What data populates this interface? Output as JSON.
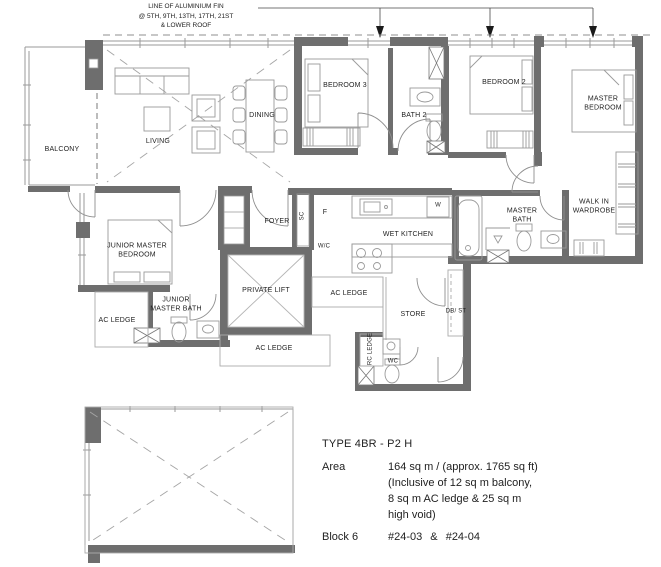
{
  "annotation": {
    "line1": "LINE OF ALUMINIUM FIN",
    "line2": "@ 5TH, 9TH, 13TH, 17TH, 21ST",
    "line3": "&  LOWER ROOF"
  },
  "rooms": {
    "balcony": "BALCONY",
    "living": "LIVING",
    "dining": "DINING",
    "bedroom3": "BEDROOM 3",
    "bath2": "BATH 2",
    "bedroom2": "BEDROOM 2",
    "master_bedroom": "MASTER BEDROOM",
    "walk_in_wardrobe": "WALK IN WARDROBE",
    "master_bath": "MASTER BATH",
    "wet_kitchen": "WET KITCHEN",
    "foyer": "FOYER",
    "junior_master_bedroom": "JUNIOR MASTER BEDROOM",
    "junior_master_bath": "JUNIOR MASTER BATH",
    "private_lift": "PRIVATE LIFT",
    "store": "STORE",
    "wc": "WC",
    "ac_ledge_left": "AC LEDGE",
    "ac_ledge_mid": "AC LEDGE",
    "ac_ledge_bottom": "AC LEDGE",
    "rc_ledge": "RC LEDGE",
    "db_st": "DB/ ST"
  },
  "fixtures": {
    "shoe_cabinet": "SC",
    "fridge": "F",
    "water_closet": "W/C",
    "washer": "W"
  },
  "info": {
    "type": "TYPE 4BR - P2 H",
    "area_label": "Area",
    "area_line1": "164 sq m / (approx. 1765 sq ft)",
    "area_line2": "(Inclusive of 12 sq m balcony,",
    "area_line3": "8 sq m AC ledge & 25 sq m",
    "area_line4": "high void)",
    "block_label": "Block 6",
    "units": "#24-03  &  #24-04"
  },
  "colors": {
    "wall": "#6e6e6e",
    "line_light": "#a8a8a8",
    "line_med": "#8f8f8f",
    "text": "#1f1f1f",
    "background": "#ffffff"
  }
}
